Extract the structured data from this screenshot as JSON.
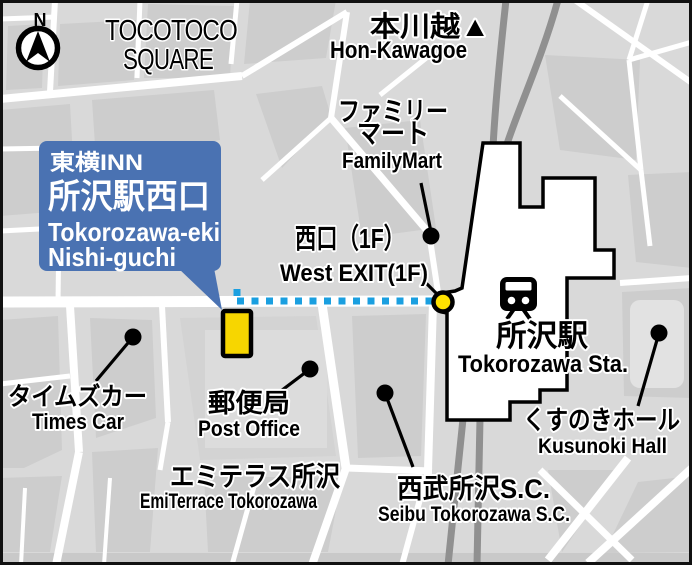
{
  "map": {
    "compass": {
      "north_label": "N"
    },
    "colors": {
      "callout_blue": "#4a72b2",
      "route_blue": "#1a9fe0",
      "marker_yellow": "#f7d600",
      "exit_yellow": "#ffe200",
      "railway_gray": "#909090",
      "road_white": "#ffffff",
      "background_gray": "#d9d9d9",
      "block_gray": "#cdcdcd"
    },
    "hotel_callout": {
      "brand_jp": "東横INN",
      "name_jp": "所沢駅西口",
      "name_en_line1": "Tokorozawa-eki",
      "name_en_line2": "Nishi-guchi"
    },
    "labels": {
      "tocotoco1": "TOCOTOCO",
      "tocotoco2": "SQUARE",
      "hon_kawagoe_jp": "本川越▲",
      "hon_kawagoe_en": "Hon-Kawagoe",
      "familymart_jp1": "ファミリー",
      "familymart_jp2": "マート",
      "familymart_en": "FamilyMart",
      "west_exit_jp": "西口（1F）",
      "west_exit_en": "West EXIT(1F)",
      "station_jp": "所沢駅",
      "station_en": "Tokorozawa Sta.",
      "times_car_jp": "タイムズカー",
      "times_car_en": "Times Car",
      "post_office_jp": "郵便局",
      "post_office_en": "Post Office",
      "emiterrace_jp": "エミテラス所沢",
      "emiterrace_en": "EmiTerrace Tokorozawa",
      "seibu_jp": "西武所沢S.C.",
      "seibu_en": "Seibu Tokorozawa S.C.",
      "kusunoki_jp": "くすのきホール",
      "kusunoki_en": "Kusunoki Hall"
    }
  }
}
